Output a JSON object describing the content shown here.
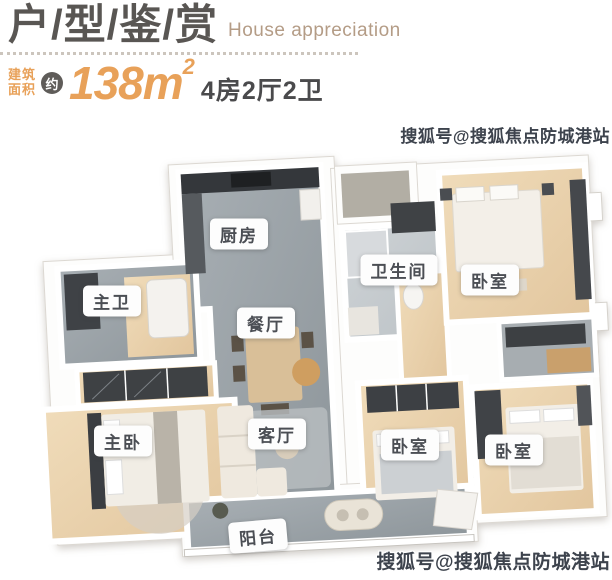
{
  "header": {
    "title": "户/型/鉴/赏",
    "subtitle": "House appreciation",
    "area_prefix_line1": "建筑",
    "area_prefix_line2": "面积",
    "approx": "约",
    "area_number": "138m",
    "area_exponent": "2",
    "layout_spec": "4房2厅2卫"
  },
  "colors": {
    "accent_orange": "#E8A159",
    "title_gray": "#595653",
    "subtitle_tan": "#B49C86",
    "label_text": "#4B4E54",
    "gray_floor": "#9AA1A6",
    "wood_floor": "#ECD5AF"
  },
  "floorplan": {
    "rooms": [
      {
        "id": "kitchen",
        "label": "厨房"
      },
      {
        "id": "bathroom",
        "label": "卫生间"
      },
      {
        "id": "bedroom-top-right",
        "label": "卧室"
      },
      {
        "id": "master-bath",
        "label": "主卫"
      },
      {
        "id": "dining",
        "label": "餐厅"
      },
      {
        "id": "master-bedroom",
        "label": "主卧"
      },
      {
        "id": "living-room",
        "label": "客厅"
      },
      {
        "id": "bedroom-middle",
        "label": "卧室"
      },
      {
        "id": "bedroom-bottom-right",
        "label": "卧室"
      },
      {
        "id": "balcony",
        "label": "阳台"
      }
    ]
  },
  "watermarks": {
    "top": "搜狐号@搜狐焦点防城港站",
    "bottom": "搜狐号@搜狐焦点防城港站"
  }
}
